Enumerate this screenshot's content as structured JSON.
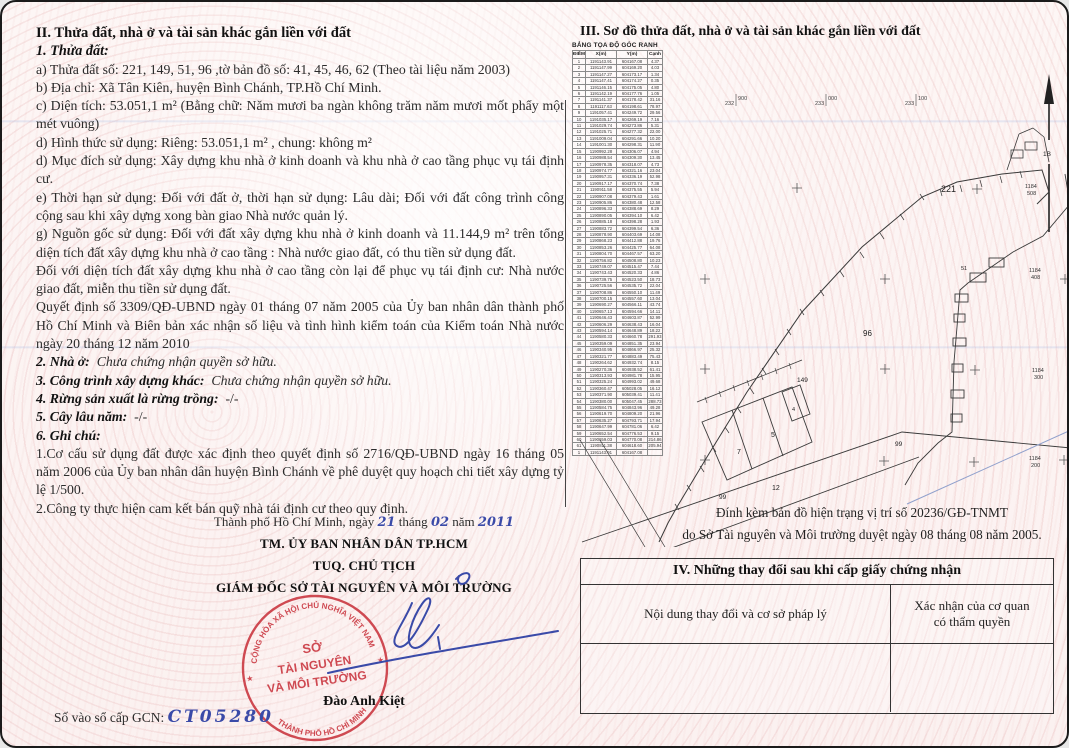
{
  "left": {
    "section_title": "II. Thửa đất, nhà ở và tài sản khác gắn liền với đất",
    "sub_title": "1. Thửa đất:",
    "paragraphs": [
      "a) Thửa đất số:  221, 149, 51, 96  ,tờ bản đồ số: 41, 45, 46, 62 (Theo tài liệu năm 2003)",
      "b) Địa chỉ:  Xã Tân Kiên, huyện Bình Chánh, TP.Hồ Chí Minh.",
      "c) Diện tích: 53.051,1 m² (Bằng chữ: Năm mươi ba ngàn không trăm năm mươi mốt phẩy một mét vuông)",
      "d) Hình thức sử dụng:  Riêng: 53.051,1 m²        , chung:  không m²",
      "d) Mục đích sử dụng:  Xây dựng khu nhà ở kinh doanh và khu nhà ở cao tầng phục vụ tái định cư.",
      "e) Thời hạn sử dụng:  Đối với đất ở, thời hạn sử dụng: Lâu dài; Đối với đất công trình công cộng sau khi xây dựng xong bàn giao Nhà nước quản lý.",
      "g) Nguồn gốc sử dụng:  Đối với đất xây dựng khu nhà ở kinh doanh và 11.144,9 m² trên tổng diện tích đất xây dựng khu nhà ở cao tầng : Nhà nước giao đất, có thu tiền sử dụng đất.",
      "Đối với diện tích đất xây dựng khu nhà ở cao tầng còn lại để phục vụ tái định cư: Nhà nước giao đất, miễn thu tiền sử dụng đất.",
      "Quyết định số 3309/QĐ-UBND ngày 01 tháng 07 năm 2005 của Ủy ban nhân dân thành phố Hồ Chí Minh và Biên bản xác nhận số liệu và tình hình kiểm toán của Kiểm toán Nhà nước ngày 20 tháng 12 năm 2010"
    ],
    "clauses": [
      {
        "label": "2. Nhà ở:",
        "value": "Chưa chứng nhận quyền sở hữu."
      },
      {
        "label": "3. Công trình xây dựng khác:",
        "value": "Chưa chứng nhận quyền sở hữu."
      },
      {
        "label": "4. Rừng sản xuất là rừng trồng:",
        "value": "-/-"
      },
      {
        "label": "5. Cây lâu năm:",
        "value": "-/-"
      },
      {
        "label": "6. Ghi chú:",
        "value": ""
      }
    ],
    "notes": [
      "1.Cơ cấu sử dụng đất được xác định theo quyết định số 2716/QĐ-UBND ngày 16 tháng 05 năm 2006 của Ủy ban nhân dân huyện Bình Chánh về phê duyệt quy hoạch chi tiết xây dựng tỷ lệ 1/500.",
      "2.Công ty thực hiện cam kết bán quỹ nhà tái định cư theo quy định."
    ],
    "signature": {
      "place_prefix": "Thành phố Hồ Chí Minh, ngày",
      "day": "21",
      "thang": "tháng",
      "month": "02",
      "nam": "năm",
      "year": "2011",
      "line1": "TM. ỦY BAN NHÂN DÂN TP.HCM",
      "line2": "TUQ. CHỦ TỊCH",
      "line3": "GIÁM ĐỐC SỞ TÀI NGUYÊN VÀ MÔI TRƯỜNG",
      "signer": "Đào Anh Kiệt"
    },
    "stamp": {
      "arc_top": "CỘNG HÒA XÃ HỘI CHỦ NGHĨA VIỆT NAM",
      "arc_bottom": "THÀNH PHỐ HỒ CHÍ MINH",
      "center1": "SỞ",
      "center2": "TÀI NGUYÊN",
      "center3": "VÀ MÔI TRƯỜNG",
      "star": "★"
    },
    "gcn_label": "Số vào sổ cấp GCN:",
    "gcn_value": "CT05280"
  },
  "right": {
    "section_title": "III. Sơ đồ thửa đất, nhà ở và tài sản khác gắn liền với đất",
    "coord_table": {
      "title": "BẢNG TỌA ĐỘ GÓC RANH",
      "headers": [
        "ĐIỂM",
        "X(m)",
        "Y(m)",
        "Cạnh"
      ],
      "rows": [
        [
          "1",
          "1191143.91",
          "604167.08",
          "4.37"
        ],
        [
          "2",
          "1191147.99",
          "604169.20",
          "4.03"
        ],
        [
          "3",
          "1191147.27",
          "604173.17",
          "1.34"
        ],
        [
          "4",
          "1191147.41",
          "604174.27",
          "0.35"
        ],
        [
          "5",
          "1191146.15",
          "604175.05",
          "4.80"
        ],
        [
          "6",
          "1191142.19",
          "604177.76",
          "1.05"
        ],
        [
          "7",
          "1191141.37",
          "604178.42",
          "31.16"
        ],
        [
          "8",
          "1191117.63",
          "604198.61",
          "78.97"
        ],
        [
          "9",
          "1191057.41",
          "604249.72",
          "29.56"
        ],
        [
          "10",
          "1191035.17",
          "604269.19",
          "7.16"
        ],
        [
          "11",
          "1191029.74",
          "604273.86",
          "5.31"
        ],
        [
          "12",
          "1191025.71",
          "604277.32",
          "22.00"
        ],
        [
          "13",
          "1191009.04",
          "604291.66",
          "10.20"
        ],
        [
          "14",
          "1191001.30",
          "604298.31",
          "11.90"
        ],
        [
          "15",
          "1190992.28",
          "604306.07",
          "4.94"
        ],
        [
          "16",
          "1190988.54",
          "604309.30",
          "13.45"
        ],
        [
          "17",
          "1190978.35",
          "604318.07",
          "4.73"
        ],
        [
          "18",
          "1190974.77",
          "604321.16",
          "23.04"
        ],
        [
          "19",
          "1190957.31",
          "604336.19",
          "52.98"
        ],
        [
          "20",
          "1190917.17",
          "604370.74",
          "7.38"
        ],
        [
          "21",
          "1190911.58",
          "604375.55",
          "5.94"
        ],
        [
          "22",
          "1190907.08",
          "604379.43",
          "1.61"
        ],
        [
          "23",
          "1190905.86",
          "604380.48",
          "12.58"
        ],
        [
          "24",
          "1190896.33",
          "604388.69",
          "8.29"
        ],
        [
          "25",
          "1190890.05",
          "604394.10",
          "6.42"
        ],
        [
          "26",
          "1190885.18",
          "604398.28",
          "1.93"
        ],
        [
          "27",
          "1190883.72",
          "604399.54",
          "6.36"
        ],
        [
          "28",
          "1190878.90",
          "604403.69",
          "14.08"
        ],
        [
          "29",
          "1190868.23",
          "604412.88",
          "19.76"
        ],
        [
          "30",
          "1190853.26",
          "604425.77",
          "64.08"
        ],
        [
          "31",
          "1190804.70",
          "604467.57",
          "63.20"
        ],
        [
          "32",
          "1190756.82",
          "604508.80",
          "10.23"
        ],
        [
          "33",
          "1190749.07",
          "604515.47",
          "7.44"
        ],
        [
          "34",
          "1190743.43",
          "604520.33",
          "4.86"
        ],
        [
          "35",
          "1190739.75",
          "604523.50",
          "18.73"
        ],
        [
          "36",
          "1190725.56",
          "604535.72",
          "22.04"
        ],
        [
          "37",
          "1190708.86",
          "604550.10",
          "11.49"
        ],
        [
          "38",
          "1190700.15",
          "604557.60",
          "13.04"
        ],
        [
          "39",
          "1190690.27",
          "604566.11",
          "43.74"
        ],
        [
          "40",
          "1190657.13",
          "604594.66",
          "14.11"
        ],
        [
          "41",
          "1190646.43",
          "604603.87",
          "52.99"
        ],
        [
          "42",
          "1190606.29",
          "604638.43",
          "16.04"
        ],
        [
          "43",
          "1190594.14",
          "604648.89",
          "18.22"
        ],
        [
          "44",
          "1190580.33",
          "604660.78",
          "291.93"
        ],
        [
          "45",
          "1190359.09",
          "604851.35",
          "23.94"
        ],
        [
          "46",
          "1190340.95",
          "604866.97",
          "25.32"
        ],
        [
          "47",
          "1190321.77",
          "604883.49",
          "75.43"
        ],
        [
          "48",
          "1190264.62",
          "604932.74",
          "8.15"
        ],
        [
          "49",
          "1190270.36",
          "604938.52",
          "61.41"
        ],
        [
          "50",
          "1190313.93",
          "604981.78",
          "15.95"
        ],
        [
          "51",
          "1190325.24",
          "604993.02",
          "49.68"
        ],
        [
          "52",
          "1190360.47",
          "605028.05",
          "16.12"
        ],
        [
          "53",
          "1190371.90",
          "605039.41",
          "11.41"
        ],
        [
          "54",
          "1190380.00",
          "605047.45",
          "288.73"
        ],
        [
          "55",
          "1190584.75",
          "604843.96",
          "49.28"
        ],
        [
          "56",
          "1190619.70",
          "604809.20",
          "21.96"
        ],
        [
          "57",
          "1190635.27",
          "604793.71",
          "17.94"
        ],
        [
          "58",
          "1190647.99",
          "604781.06",
          "6.42"
        ],
        [
          "59",
          "1190652.54",
          "604776.53",
          "9.15"
        ],
        [
          "60",
          "1190659.03",
          "604770.08",
          "214.86"
        ],
        [
          "61",
          "1190811.38",
          "604618.60",
          "205.94"
        ],
        [
          "1",
          "1191143.91",
          "604167.08",
          ""
        ]
      ]
    },
    "map": {
      "grid_labels": [
        {
          "left": "232",
          "right": "900"
        },
        {
          "left": "233",
          "right": "000"
        },
        {
          "left": "233",
          "right": "100"
        }
      ],
      "north_label": "1B",
      "parcels": {
        "p221": "221",
        "p96": "96",
        "p149": "149",
        "p51": "51",
        "p7": "7",
        "p5": "5",
        "p4": "4",
        "p12": "12",
        "p99a": "99",
        "p99b": "99"
      },
      "fractions": [
        {
          "top": "1184",
          "bottom": "508"
        },
        {
          "top": "1184",
          "bottom": "408"
        },
        {
          "top": "1184",
          "bottom": "300"
        },
        {
          "top": "1184",
          "bottom": "200"
        }
      ],
      "attachment_line1": "Đính kèm bản đồ hiện trạng vị trí số 20236/GĐ-TNMT",
      "attachment_line2": "do Sở Tài nguyên và Môi trường duyệt ngày 08 tháng 08 năm 2005."
    },
    "section4": {
      "title": "IV. Những thay đổi sau khi cấp giấy chứng nhận",
      "col1": "Nội dung thay đổi và cơ sở pháp lý",
      "col2_line1": "Xác nhận của cơ quan",
      "col2_line2": "có thẩm quyền"
    }
  },
  "colors": {
    "stamp_red": "#c9333d",
    "hand_blue": "#3a4aa8",
    "ink": "#2b2b2b"
  }
}
